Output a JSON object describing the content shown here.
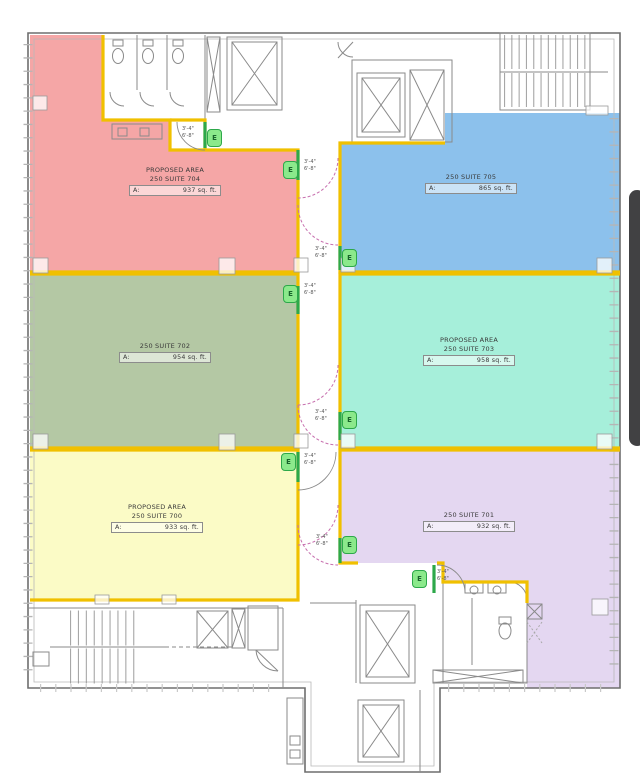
{
  "page": {
    "background": "#ffffff"
  },
  "colors": {
    "demising_line": "#f0c000",
    "wall": "#6e6e6e",
    "wall_light": "#b8b8b8",
    "jamb_green": "#2da84a",
    "tag_fill": "#8be98b",
    "swing_magenta": "#c76fae",
    "scrollbar": "#414143"
  },
  "suites": [
    {
      "id": "704",
      "prefix": "PROPOSED AREA",
      "name": "250 SUITE 704",
      "area_label": "A:",
      "area_value": "937 sq. ft.",
      "color": "#f5a6a6"
    },
    {
      "id": "705",
      "prefix": "",
      "name": "250 SUITE 705",
      "area_label": "A:",
      "area_value": "865 sq. ft.",
      "color": "#8cc1ec"
    },
    {
      "id": "702",
      "prefix": "",
      "name": "250 SUITE 702",
      "area_label": "A:",
      "area_value": "954 sq. ft.",
      "color": "#b4c8a4"
    },
    {
      "id": "703",
      "prefix": "PROPOSED AREA",
      "name": "250 SUITE 703",
      "area_label": "A:",
      "area_value": "958 sq. ft.",
      "color": "#a6efda"
    },
    {
      "id": "700",
      "prefix": "PROPOSED AREA",
      "name": "250 SUITE 700",
      "area_label": "A:",
      "area_value": "933 sq. ft.",
      "color": "#fbfbc6"
    },
    {
      "id": "701",
      "prefix": "",
      "name": "250 SUITE 701",
      "area_label": "A:",
      "area_value": "932 sq. ft.",
      "color": "#e4d7f1"
    }
  ],
  "doors": [
    {
      "id": "suite-704-vestibule-door",
      "tag": "E",
      "width": "3'-4\"",
      "height": "6'-8\""
    },
    {
      "id": "suite-704-corridor-door",
      "tag": "E",
      "width": "3'-4\"",
      "height": "6'-8\""
    },
    {
      "id": "suite-705-door",
      "tag": "E",
      "width": "3'-4\"",
      "height": "6'-8\""
    },
    {
      "id": "suite-702-door",
      "tag": "E",
      "width": "3'-4\"",
      "height": "6'-8\""
    },
    {
      "id": "suite-703-door",
      "tag": "E",
      "width": "3'-4\"",
      "height": "6'-8\""
    },
    {
      "id": "suite-700-door",
      "tag": "E",
      "width": "3'-4\"",
      "height": "6'-8\""
    },
    {
      "id": "suite-701-corridor-door",
      "tag": "E",
      "width": "3'-4\"",
      "height": "6'-8\""
    },
    {
      "id": "suite-701-restroom-door",
      "tag": "E",
      "width": "3'-4\"",
      "height": "6'-8\""
    }
  ]
}
